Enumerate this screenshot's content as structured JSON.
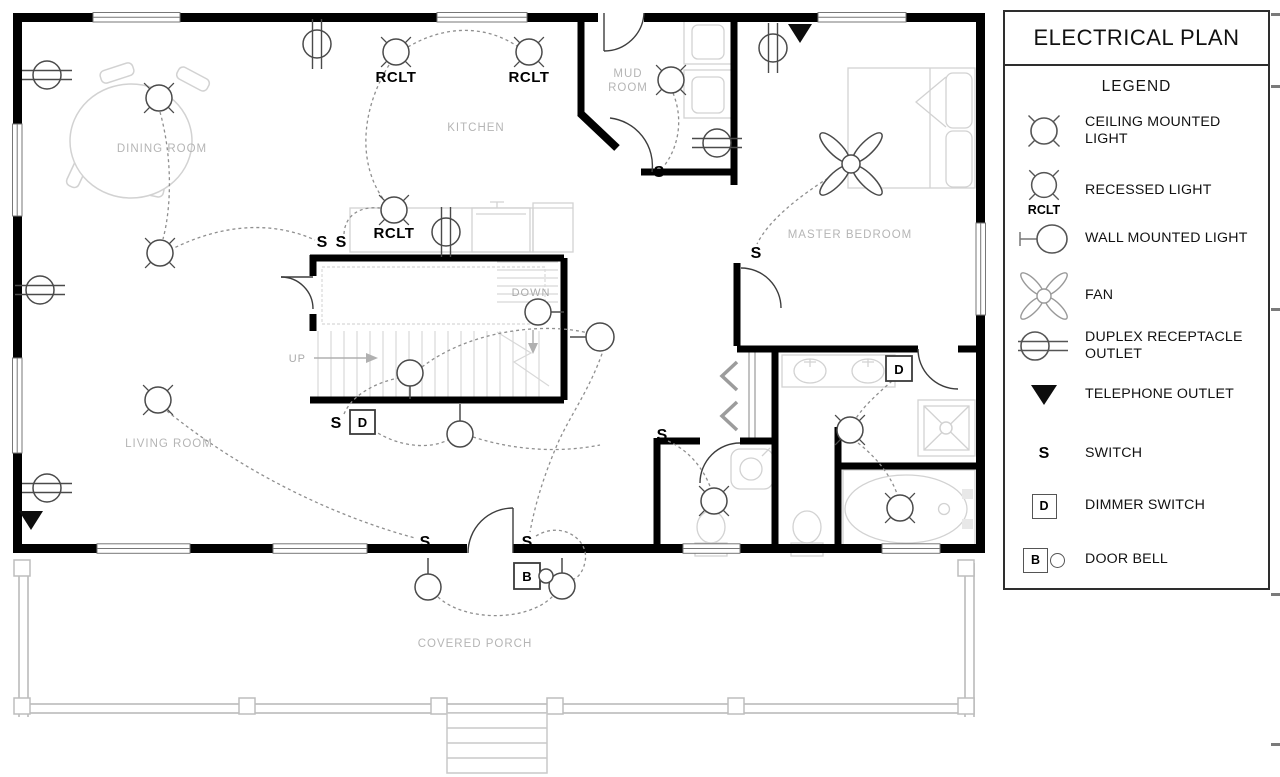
{
  "title": "ELECTRICAL PLAN",
  "legend": {
    "heading": "LEGEND",
    "items": [
      {
        "icon": "ceiling-mounted-light-icon",
        "label": "CEILING MOUNTED LIGHT"
      },
      {
        "icon": "recessed-light-icon",
        "label": "RECESSED LIGHT",
        "tag": "RCLT"
      },
      {
        "icon": "wall-mounted-light-icon",
        "label": "WALL MOUNTED LIGHT"
      },
      {
        "icon": "fan-icon",
        "label": "FAN"
      },
      {
        "icon": "duplex-receptacle-outlet-icon",
        "label": "DUPLEX RECEPTACLE OUTLET"
      },
      {
        "icon": "telephone-outlet-icon",
        "label": "TELEPHONE OUTLET"
      },
      {
        "icon": "switch-icon",
        "label": "SWITCH",
        "letter": "S"
      },
      {
        "icon": "dimmer-switch-icon",
        "label": "DIMMER SWITCH",
        "letter": "D"
      },
      {
        "icon": "door-bell-icon",
        "label": "DOOR BELL",
        "letter": "B"
      }
    ]
  },
  "rooms": {
    "dining": "DINING ROOM",
    "kitchen": "KITCHEN",
    "mud_line1": "MUD",
    "mud_line2": "ROOM",
    "master": "MASTER BEDROOM",
    "living": "LIVING ROOM",
    "porch": "COVERED PORCH"
  },
  "stairs": {
    "up": "UP",
    "down": "DOWN"
  },
  "symbols": {
    "switch": "S",
    "dimmer": "D",
    "doorbell": "B",
    "recessed": "RCLT"
  },
  "colors": {
    "wall": "#000000",
    "fixture": "#d2d2d2",
    "wiring": "#8f8f8f",
    "room_label": "#b5b5b5",
    "symbol": "#4a4a4a"
  }
}
